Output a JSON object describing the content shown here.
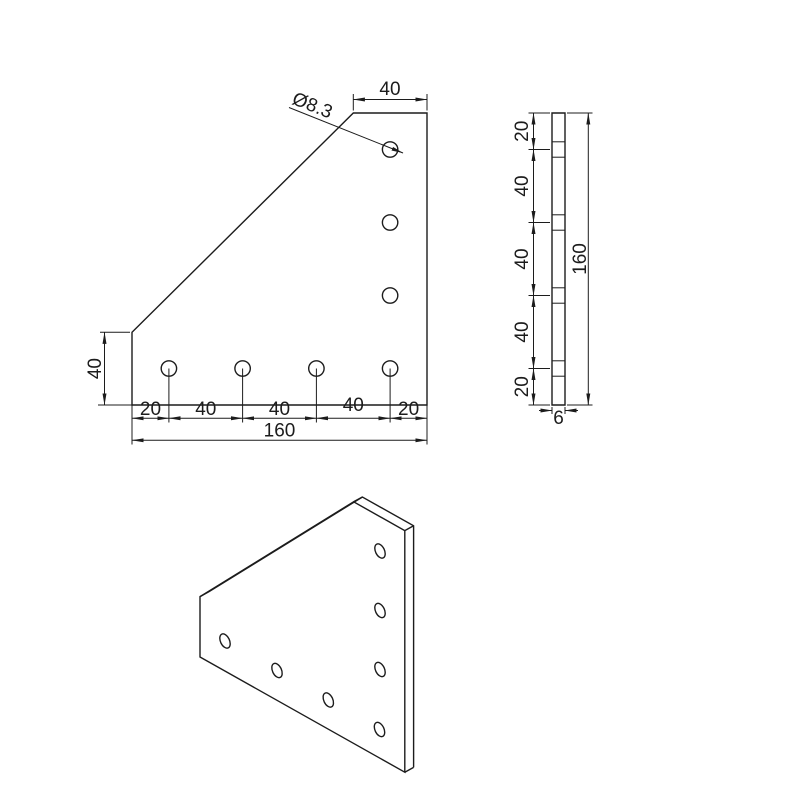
{
  "page": {
    "background": "#ffffff",
    "ink": "#1c1c1c",
    "title": "90 degree joining plate technical drawing"
  },
  "part": {
    "overall_width_mm": "160",
    "overall_height_mm": "160",
    "thickness_mm": "6",
    "hole_count": 7,
    "hole_diameter_mm": "8.3"
  },
  "front_view": {
    "dim_top": "40",
    "hole_diameter_label": "Ø8.3",
    "dim_left": "40",
    "dim_chain": [
      "20",
      "40",
      "40",
      "40",
      "20"
    ],
    "dim_total": "160"
  },
  "side_view": {
    "dim_chain": [
      "20",
      "40",
      "40",
      "40",
      "20"
    ],
    "dim_total": "160",
    "dim_thickness": "6"
  }
}
